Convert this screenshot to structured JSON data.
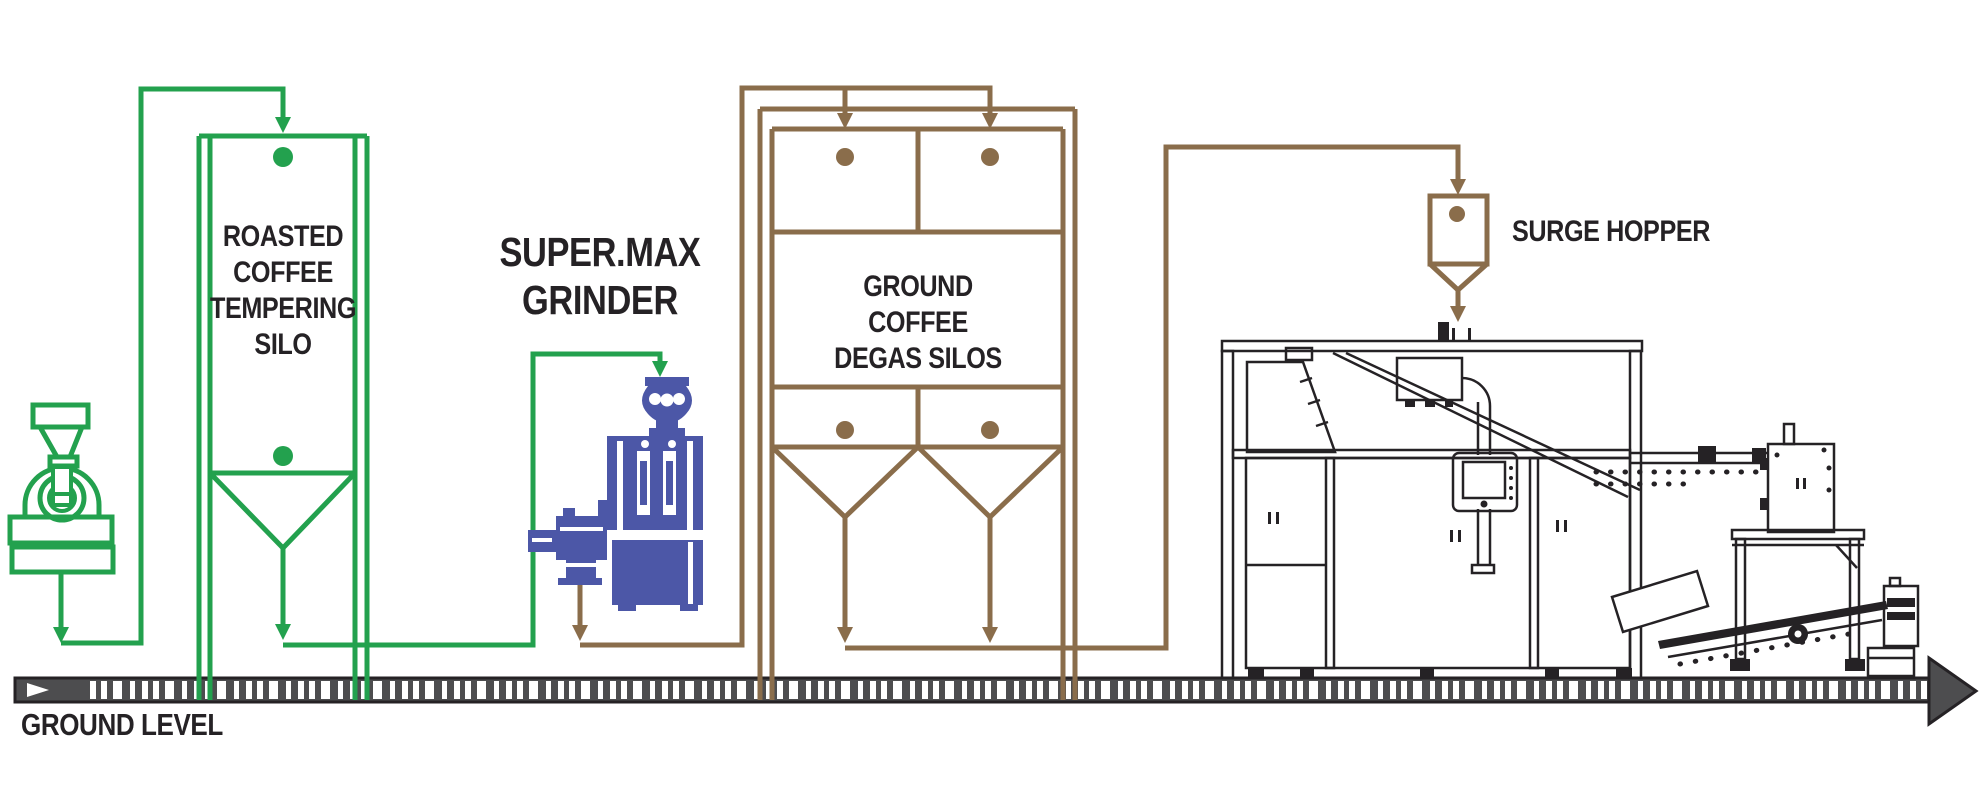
{
  "diagram": {
    "labels": {
      "tempering_silo": "ROASTED\nCOFFEE\nTEMPERING\nSILO",
      "grinder": "SUPER.MAX\nGRINDER",
      "degas_silos": "GROUND COFFEE\nDEGAS SILOS",
      "surge_hopper": "SURGE HOPPER",
      "ground_level": "GROUND LEVEL"
    },
    "colors": {
      "green": "#23A14E",
      "brown": "#8A6D4B",
      "blue": "#4C57A7",
      "ink": "#252225",
      "bar": "#4D4D4F"
    }
  }
}
